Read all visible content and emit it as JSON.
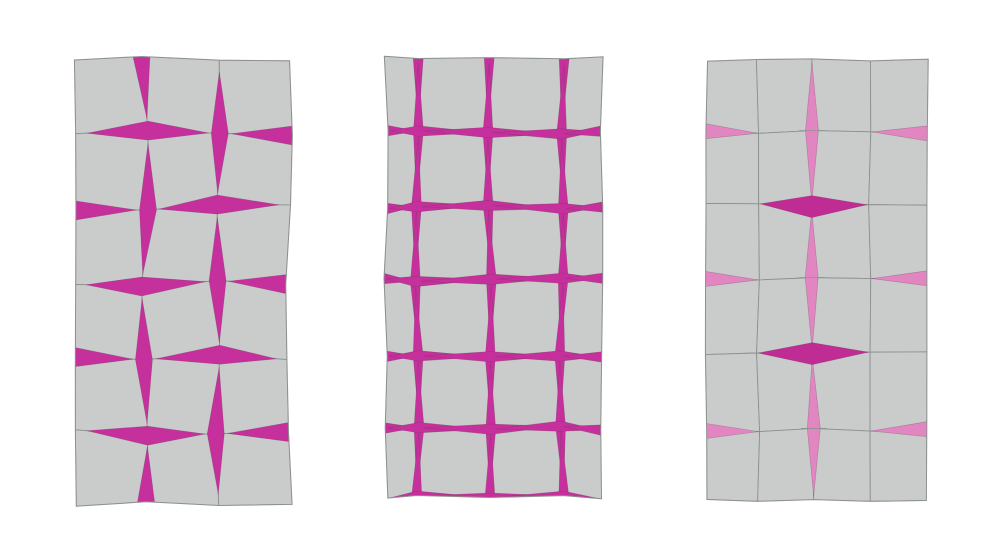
{
  "figure": {
    "background": "#ffffff",
    "canvas": {
      "width": 1000,
      "height": 557
    },
    "colors": {
      "tile_fill": "#c9cccb",
      "tile_stroke": "#8d918f",
      "magenta": "#c6309c",
      "deep_magenta": "#bf2c93",
      "pink": "#e186c0"
    },
    "panels": [
      {
        "id": "panel-left-alternating-diamonds",
        "col_edges": [
          73,
          145,
          217,
          289
        ],
        "row_edges": [
          58,
          133,
          208,
          283,
          358,
          433,
          503
        ],
        "jitter_amp": 3.6,
        "seed": 3,
        "defaults": {
          "reach": 0.84,
          "wV": 8.5,
          "wH": 9.5,
          "color": "magenta"
        },
        "openings": [
          [
            1,
            0,
            "V"
          ],
          [
            2,
            1,
            "V"
          ],
          [
            1,
            2,
            "V"
          ],
          [
            2,
            3,
            "V"
          ],
          [
            1,
            4,
            "V"
          ],
          [
            2,
            5,
            "V"
          ],
          [
            1,
            6,
            "V"
          ],
          [
            1,
            1,
            "H"
          ],
          [
            2,
            2,
            "H"
          ],
          [
            1,
            3,
            "H"
          ],
          [
            2,
            4,
            "H"
          ],
          [
            1,
            5,
            "H"
          ],
          [
            0,
            2,
            "H"
          ],
          [
            0,
            4,
            "H"
          ],
          [
            3,
            1,
            "H"
          ],
          [
            3,
            3,
            "H"
          ],
          [
            3,
            5,
            "H"
          ]
        ]
      },
      {
        "id": "panel-middle-fully-open-grid",
        "col_edges": [
          386,
          417,
          490,
          562,
          601
        ],
        "row_edges": [
          58,
          132,
          207,
          280,
          357,
          428,
          497
        ],
        "jitter_amp": 2.2,
        "seed": 8,
        "defaults": {
          "reach": 0.93,
          "wV": 5,
          "wH": 5.2,
          "color": "magenta"
        },
        "openings": [
          [
            1,
            0,
            "V"
          ],
          [
            2,
            0,
            "V"
          ],
          [
            3,
            0,
            "V"
          ],
          [
            1,
            1,
            "V"
          ],
          [
            2,
            1,
            "V"
          ],
          [
            3,
            1,
            "V"
          ],
          [
            1,
            2,
            "V"
          ],
          [
            2,
            2,
            "V"
          ],
          [
            3,
            2,
            "V"
          ],
          [
            1,
            3,
            "V"
          ],
          [
            2,
            3,
            "V"
          ],
          [
            3,
            3,
            "V"
          ],
          [
            1,
            4,
            "V"
          ],
          [
            2,
            4,
            "V"
          ],
          [
            3,
            4,
            "V"
          ],
          [
            1,
            5,
            "V"
          ],
          [
            2,
            5,
            "V"
          ],
          [
            3,
            5,
            "V"
          ],
          [
            1,
            6,
            "V"
          ],
          [
            2,
            6,
            "V"
          ],
          [
            3,
            6,
            "V"
          ],
          [
            0,
            1,
            "H"
          ],
          [
            1,
            1,
            "H"
          ],
          [
            2,
            1,
            "H"
          ],
          [
            3,
            1,
            "H"
          ],
          [
            4,
            1,
            "H"
          ],
          [
            0,
            2,
            "H"
          ],
          [
            1,
            2,
            "H"
          ],
          [
            2,
            2,
            "H"
          ],
          [
            3,
            2,
            "H"
          ],
          [
            4,
            2,
            "H"
          ],
          [
            0,
            3,
            "H"
          ],
          [
            1,
            3,
            "H"
          ],
          [
            2,
            3,
            "H"
          ],
          [
            3,
            3,
            "H"
          ],
          [
            4,
            3,
            "H"
          ],
          [
            0,
            4,
            "H"
          ],
          [
            1,
            4,
            "H"
          ],
          [
            2,
            4,
            "H"
          ],
          [
            3,
            4,
            "H"
          ],
          [
            4,
            4,
            "H"
          ],
          [
            0,
            5,
            "H"
          ],
          [
            1,
            5,
            "H"
          ],
          [
            2,
            5,
            "H"
          ],
          [
            3,
            5,
            "H"
          ],
          [
            4,
            5,
            "H"
          ],
          [
            1,
            6,
            "H",
            null,
            4.5
          ],
          [
            2,
            6,
            "H",
            null,
            4.5
          ],
          [
            3,
            6,
            "H",
            null,
            4.5
          ]
        ]
      },
      {
        "id": "panel-right-localized-openings",
        "col_edges": [
          706,
          758,
          813,
          870,
          927
        ],
        "row_edges": [
          60,
          132,
          205,
          279,
          353,
          430,
          500
        ],
        "jitter_amp": 1.7,
        "seed": 5,
        "defaults": {
          "reach": 0.95,
          "wV": 6.5,
          "wH": 7.5,
          "color": "pink"
        },
        "openings": [
          [
            2,
            1,
            "V",
            "pink",
            6.5,
            0.95,
            1
          ],
          [
            2,
            3,
            "V",
            "pink",
            6.5,
            0.95,
            1
          ],
          [
            2,
            5,
            "V",
            "pink",
            6.5,
            0.95,
            1
          ],
          [
            2,
            2,
            "H",
            "deep_magenta",
            11,
            0.97
          ],
          [
            2,
            4,
            "H",
            "deep_magenta",
            11,
            0.97
          ],
          [
            0,
            1,
            "H",
            "pink",
            7.5,
            0.98
          ],
          [
            4,
            1,
            "H",
            "pink",
            7.5,
            0.98
          ],
          [
            0,
            3,
            "H",
            "pink",
            7.5,
            0.98
          ],
          [
            4,
            3,
            "H",
            "pink",
            7.5,
            0.98
          ],
          [
            0,
            5,
            "H",
            "pink",
            7.5,
            0.98
          ],
          [
            4,
            5,
            "H",
            "pink",
            7.5,
            0.98
          ]
        ]
      }
    ]
  }
}
